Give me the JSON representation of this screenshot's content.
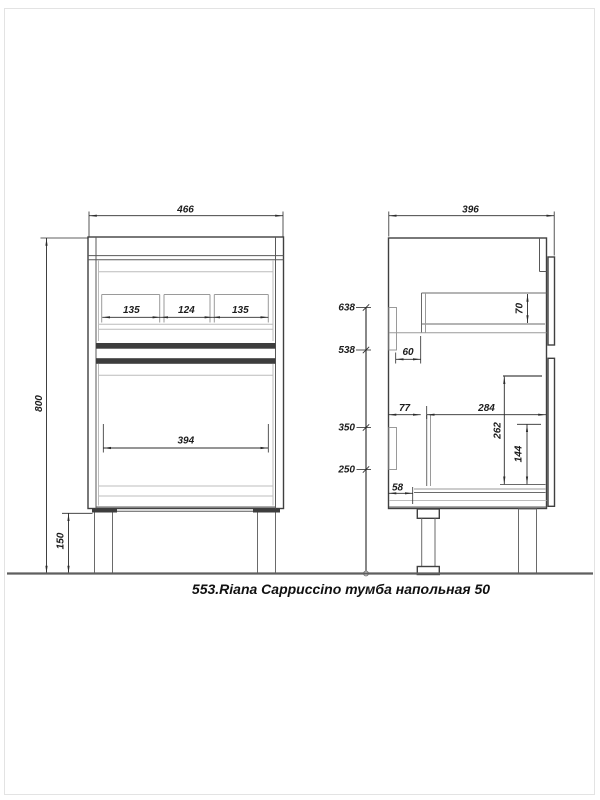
{
  "caption": "553.Riana Cappuccino тумба напольная 50",
  "front_view": {
    "overall_width": "466",
    "overall_height": "800",
    "leg_height": "150",
    "top_drawer_sections": [
      "135",
      "124",
      "135"
    ],
    "lower_drawer_width": "394"
  },
  "side_view": {
    "overall_depth": "396",
    "height_marks": [
      "638",
      "538",
      "350",
      "250"
    ],
    "top_box_height": "70",
    "rail_offset": "60",
    "back_offset": "77",
    "inner_depth": "284",
    "lower_box_height": "262",
    "lower_inner_height": "144",
    "bottom_offset": "58"
  },
  "colors": {
    "line": "#404040",
    "dim_line": "#2b2b2b",
    "light_line": "#bcbcbc",
    "band": "#3d3d3d",
    "ground": "#5f5f5f",
    "page_border": "#e3e3e3",
    "background": "#ffffff"
  }
}
